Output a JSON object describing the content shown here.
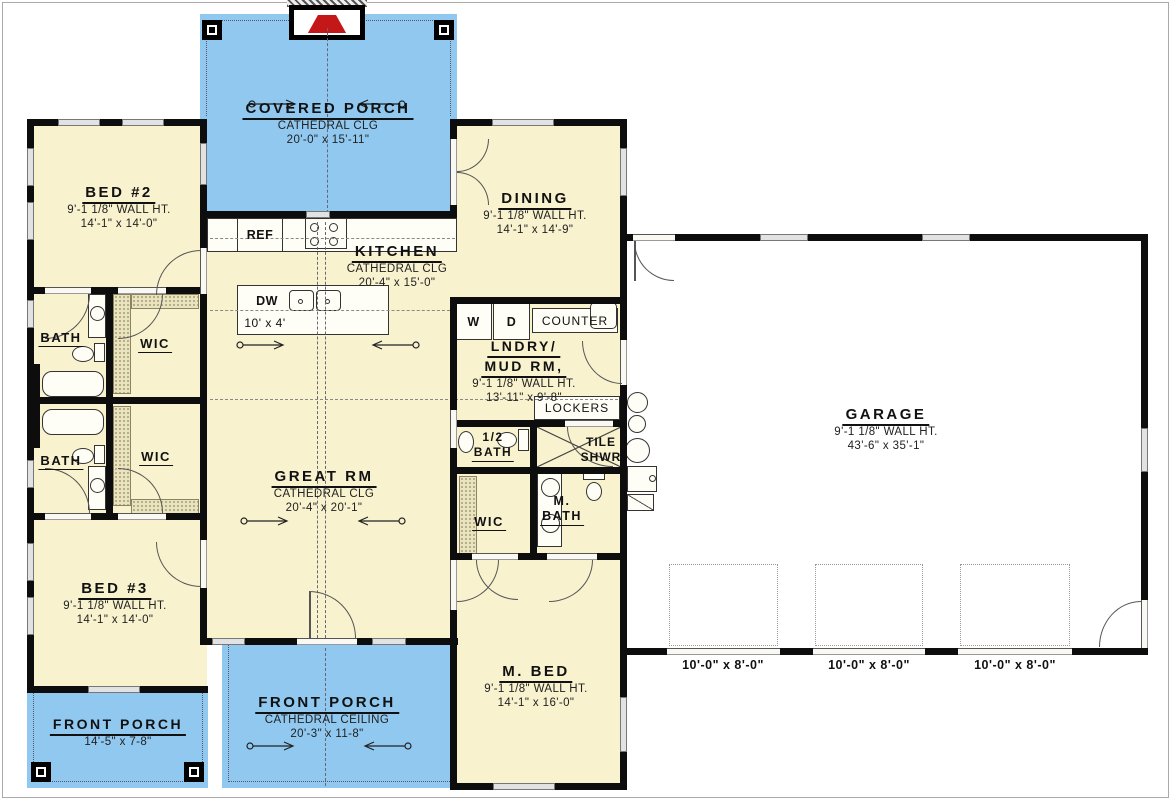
{
  "colors": {
    "porch_blue": "#90c8f0",
    "room_yellow": "#f8f2cf",
    "wall_black": "#0d0d0d",
    "garage_white": "#ffffff",
    "fireplace_red": "#c41717",
    "shelf_hatch": "#eae3bf"
  },
  "rooms": {
    "covered_porch": {
      "name": "COVERED PORCH",
      "line2": "CATHEDRAL CLG",
      "line3": "20'-0\" x 15'-11\""
    },
    "bed2": {
      "name": "BED #2",
      "line2": "9'-1 1/8\" WALL HT.",
      "line3": "14'-1\" x 14'-0\""
    },
    "dining": {
      "name": "DINING",
      "line2": "9'-1 1/8\" WALL HT.",
      "line3": "14'-1\" x 14'-9\""
    },
    "kitchen": {
      "name": "KITCHEN",
      "line2": "CATHEDRAL CLG",
      "line3": "20'-4\" x 15'-0\""
    },
    "great_rm": {
      "name": "GREAT RM",
      "line2": "CATHEDRAL CLG",
      "line3": "20'-4\" x 20'-1\""
    },
    "lndry": {
      "name": "LNDRY/",
      "name2": "MUD RM,",
      "line2": "9'-1 1/8\" WALL HT.",
      "line3": "13'-11\" x 9'-8\""
    },
    "garage": {
      "name": "GARAGE",
      "line2": "9'-1 1/8\" WALL HT.",
      "line3": "43'-6\" x 35'-1\""
    },
    "bed3": {
      "name": "BED #3",
      "line2": "9'-1 1/8\" WALL HT.",
      "line3": "14'-1\" x 14'-0\""
    },
    "m_bed": {
      "name": "M. BED",
      "line2": "9'-1 1/8\" WALL HT.",
      "line3": "14'-1\" x 16'-0\""
    },
    "front_porch_left": {
      "name": "FRONT PORCH",
      "line3": "14'-5\" x 7-8\""
    },
    "front_porch_center": {
      "name": "FRONT PORCH",
      "line2": "CATHEDRAL CEILING",
      "line3": "20'-3\" x 11-8\""
    }
  },
  "small": {
    "bath_upper": {
      "name": "BATH"
    },
    "wic_upper": {
      "name": "WIC"
    },
    "bath_lower": {
      "name": "BATH"
    },
    "wic_lower": {
      "name": "WIC"
    },
    "half_bath": {
      "name": "1/2",
      "name2": "BATH"
    },
    "tile_shwr": {
      "name": "TILE",
      "name2": "SHWR"
    },
    "m_wic": {
      "name": "WIC"
    },
    "m_bath": {
      "name": "M.",
      "name2": "BATH"
    }
  },
  "fixtures": {
    "ref": "REF",
    "dw": "DW",
    "island_dims": "10' x 4'",
    "washer": "W",
    "dryer": "D",
    "counter": "COUNTER",
    "lockers": "LOCKERS"
  },
  "garage_doors": [
    "10'-0\" x 8'-0\"",
    "10'-0\" x 8'-0\"",
    "10'-0\" x 8'-0\""
  ]
}
